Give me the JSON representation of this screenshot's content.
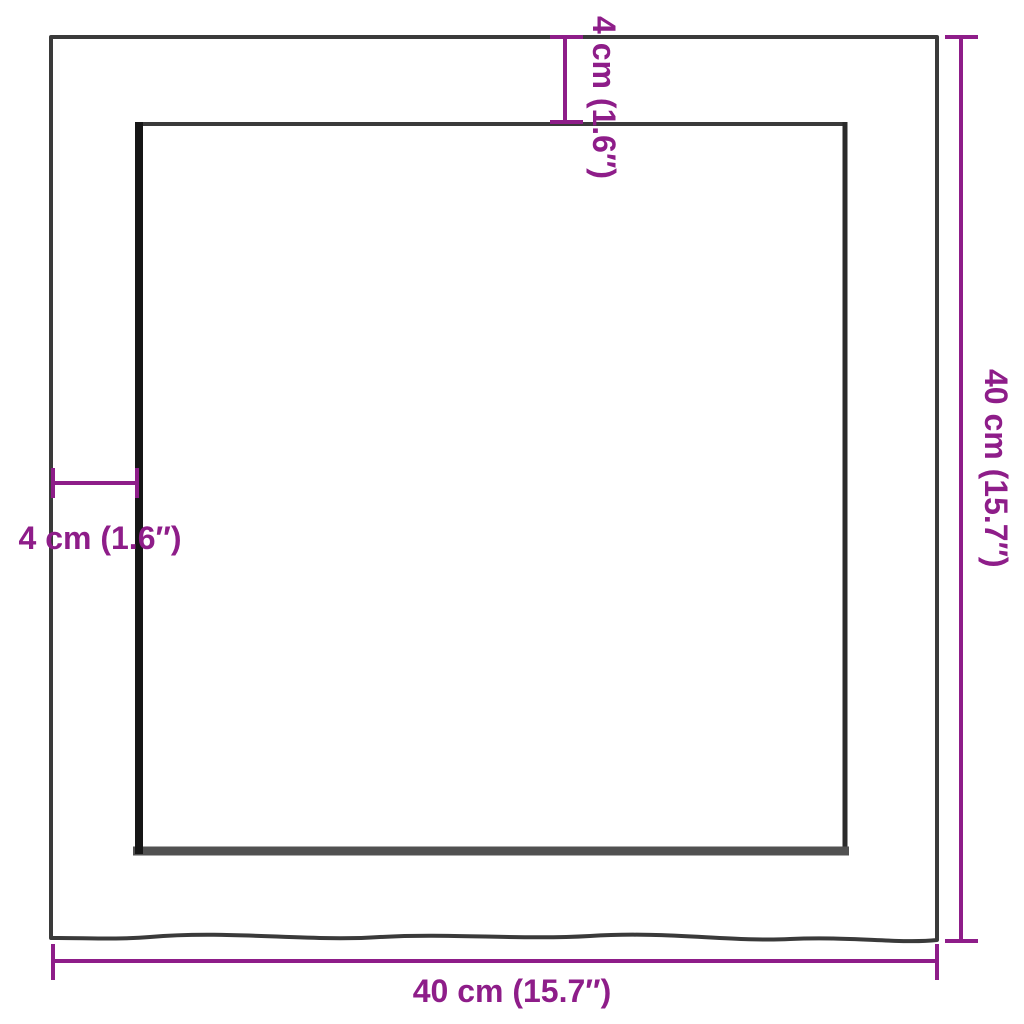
{
  "page": {
    "background": "#ffffff",
    "description": "Product dimension diagram: square panel (top view) with inner offset edge"
  },
  "colors": {
    "annotation_purple": "#8E1D89",
    "outline_dark": "#3a3a3a",
    "inner_edge_black": "#161616",
    "inner_edge_shadow": "#515151"
  },
  "dimensions": {
    "top_offset": {
      "label": "4 cm (1.6″)",
      "orientation": "vertical-rotated"
    },
    "left_offset": {
      "label": "4 cm (1.6″)",
      "orientation": "horizontal"
    },
    "overall_height": {
      "label": "40 cm (15.7″)",
      "orientation": "vertical-rotated"
    },
    "overall_width": {
      "label": "40 cm (15.7″)",
      "orientation": "horizontal"
    }
  }
}
